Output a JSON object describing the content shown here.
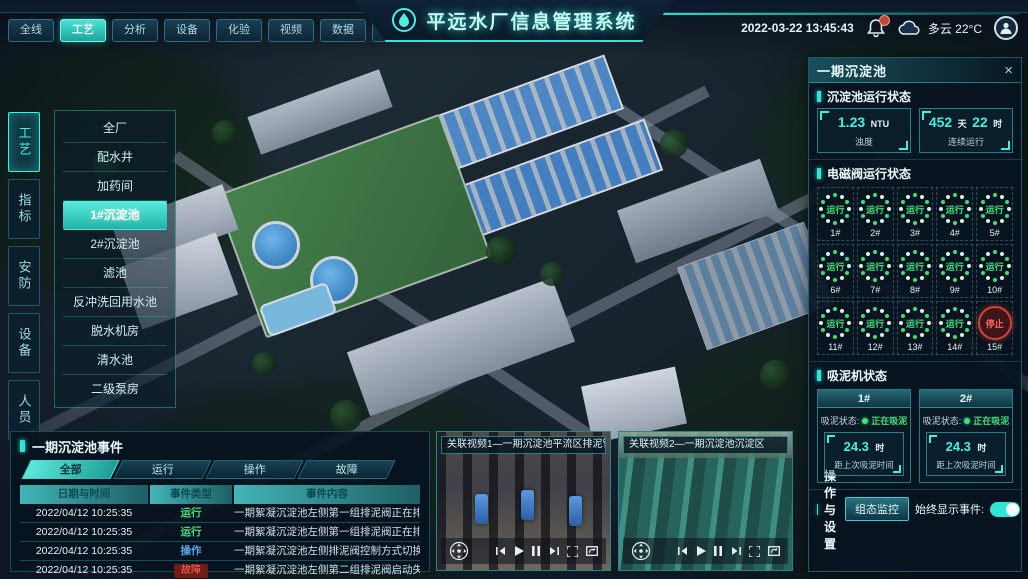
{
  "header": {
    "title": "平远水厂信息管理系统",
    "tabs": [
      {
        "label": "全线"
      },
      {
        "label": "工艺"
      },
      {
        "label": "分析"
      },
      {
        "label": "设备"
      },
      {
        "label": "化验"
      },
      {
        "label": "视频"
      },
      {
        "label": "数据"
      },
      {
        "label": "工单"
      },
      {
        "label": "系统"
      }
    ],
    "datetime": "2022-03-22 13:45:43",
    "weather": "多云 22°C"
  },
  "left_tabs": [
    {
      "label": "工艺"
    },
    {
      "label": "指标"
    },
    {
      "label": "安防"
    },
    {
      "label": "设备"
    },
    {
      "label": "人员"
    }
  ],
  "left_menu": [
    {
      "label": "全厂"
    },
    {
      "label": "配水井"
    },
    {
      "label": "加药间"
    },
    {
      "label": "1#沉淀池"
    },
    {
      "label": "2#沉淀池"
    },
    {
      "label": "滤池"
    },
    {
      "label": "反冲洗回用水池"
    },
    {
      "label": "脱水机房"
    },
    {
      "label": "清水池"
    },
    {
      "label": "二级泵房"
    }
  ],
  "right_panel": {
    "title": "一期沉淀池",
    "close_icon": "×",
    "run_status": {
      "title": "沉淀池运行状态",
      "stats": [
        {
          "v1": "1.23",
          "u1": "NTU",
          "label": "浊度"
        },
        {
          "v1": "452",
          "u1": "天",
          "v2": "22",
          "u2": "时",
          "label": "连续运行"
        }
      ]
    },
    "valves": {
      "title": "电磁阀运行状态",
      "items": [
        {
          "id": "1#",
          "status": "运行"
        },
        {
          "id": "2#",
          "status": "运行"
        },
        {
          "id": "3#",
          "status": "运行"
        },
        {
          "id": "4#",
          "status": "运行"
        },
        {
          "id": "5#",
          "status": "运行"
        },
        {
          "id": "6#",
          "status": "运行"
        },
        {
          "id": "7#",
          "status": "运行"
        },
        {
          "id": "8#",
          "status": "运行"
        },
        {
          "id": "9#",
          "status": "运行"
        },
        {
          "id": "10#",
          "status": "运行"
        },
        {
          "id": "11#",
          "status": "运行"
        },
        {
          "id": "12#",
          "status": "运行"
        },
        {
          "id": "13#",
          "status": "运行"
        },
        {
          "id": "14#",
          "status": "运行"
        },
        {
          "id": "15#",
          "status": "停止"
        }
      ]
    },
    "scraper": {
      "title": "吸泥机状态",
      "units": [
        {
          "id": "1#",
          "state_label": "吸泥状态:",
          "state": "正在吸泥",
          "value": "24.3",
          "unit": "时",
          "caption": "距上次吸泥时间"
        },
        {
          "id": "2#",
          "state_label": "吸泥状态:",
          "state": "正在吸泥",
          "value": "24.3",
          "unit": "时",
          "caption": "距上次吸泥时间"
        }
      ]
    },
    "ops": {
      "title": "操作与设置",
      "button": "组态监控",
      "toggle_label": "始终显示事件:"
    }
  },
  "events": {
    "title": "一期沉淀池事件",
    "tabs": [
      {
        "label": "全部"
      },
      {
        "label": "运行"
      },
      {
        "label": "操作"
      },
      {
        "label": "故障"
      }
    ],
    "columns": [
      "日期与时间",
      "事件类型",
      "事件内容"
    ],
    "rows": [
      {
        "time": "2022/04/12 10:25:35",
        "type": "运行",
        "content": "一期絮凝沉淀池左侧第一组排泥阀正在排泥"
      },
      {
        "time": "2022/04/12 10:25:35",
        "type": "运行",
        "content": "一期絮凝沉淀池左侧第一组排泥阀正在排泥"
      },
      {
        "time": "2022/04/12 10:25:35",
        "type": "操作",
        "content": "一期絮凝沉淀池左侧排泥阀控制方式切换为手动"
      },
      {
        "time": "2022/04/12 10:25:35",
        "type": "故障",
        "content": "一期絮凝沉淀池左侧第二组排泥阀启动失败"
      }
    ]
  },
  "videos": [
    {
      "title": "关联视频1—一期沉淀池平流区排泥管廊"
    },
    {
      "title": "关联视频2—一期沉淀池沉淀区"
    }
  ]
}
